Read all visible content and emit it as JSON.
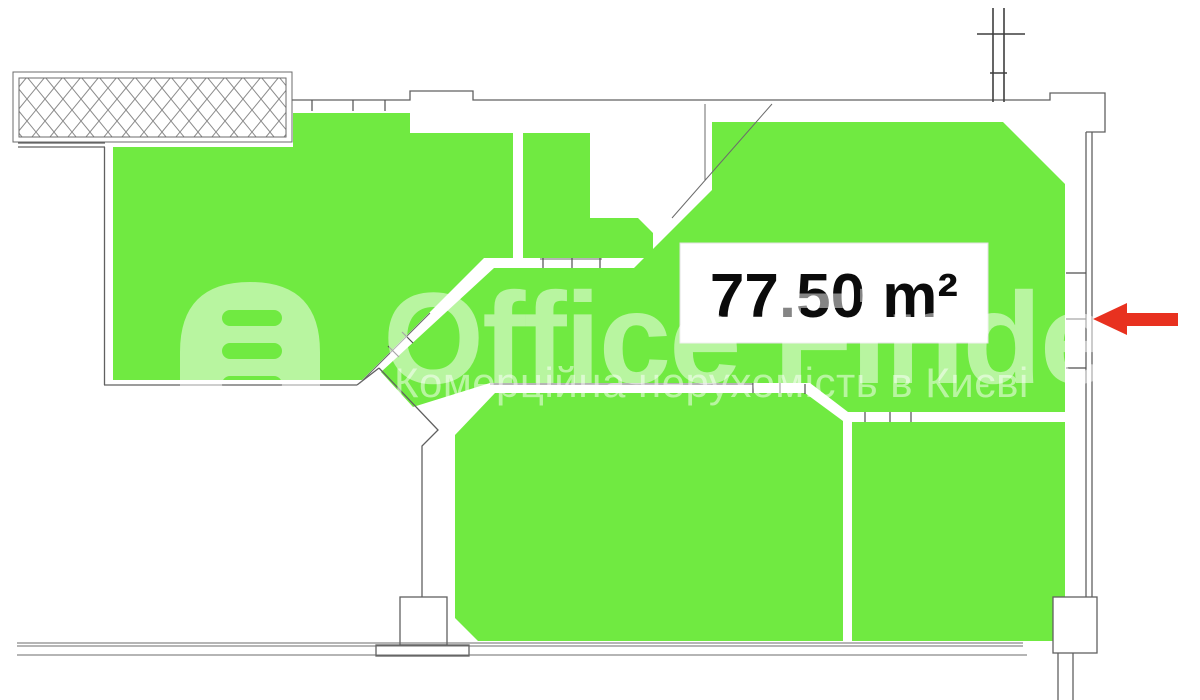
{
  "area_label": {
    "value": "77.50 m²"
  },
  "watermark": {
    "title": "Office Finder",
    "subtitle": "Комерційна нерухомість в Києві",
    "icon": "building-icon"
  },
  "icons": {
    "arrow": "arrow-left-icon",
    "survey_mark": "survey-cross-icon",
    "insulated_wall": "hatched-wall-block"
  },
  "colors": {
    "unit_fill": "#70ea41",
    "arrow": "#e8311f",
    "wall_line": "#606060",
    "label_text": "#0b0b0b",
    "watermark": "rgba(255,255,255,0.5)"
  }
}
